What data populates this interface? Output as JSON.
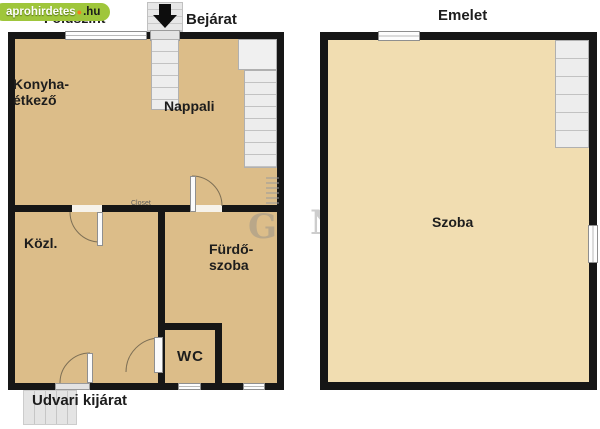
{
  "badge": {
    "site": "aprohirdetes",
    "dot": "●",
    "tld": ".hu"
  },
  "ground": {
    "title": "Földszint",
    "entrance": "Bejárat",
    "exit": "Udvari kijárat",
    "kitchen": [
      "Konyha-",
      "étkező"
    ],
    "living": "Nappali",
    "hall": "Közl.",
    "bath": [
      "Fürdő-",
      "szoba"
    ],
    "wc": "WC",
    "closet": "Closet"
  },
  "upper": {
    "title": "Emelet",
    "room": "Szoba"
  },
  "watermark": {
    "letter_g": "G",
    "letter_n": "N"
  },
  "colors": {
    "ground_floor_fill": "#dcbd89",
    "upper_floor_fill": "#f1ddb1",
    "wall": "#161616",
    "badge_green": "#9fc63b",
    "badge_accent": "#f27c1e",
    "stairs_grey": "#ededed"
  }
}
